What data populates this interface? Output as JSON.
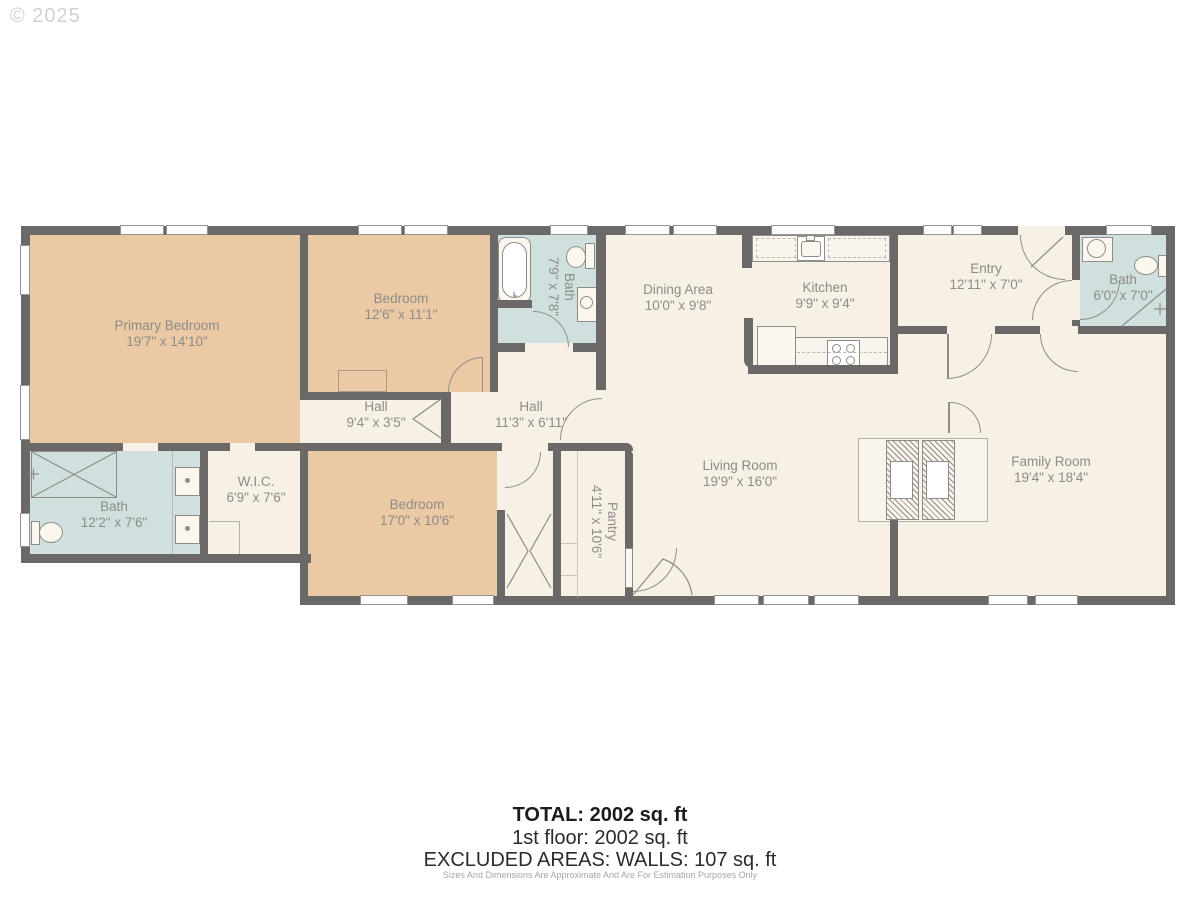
{
  "watermark": "© 2025",
  "colors": {
    "wall": "#6a6967",
    "floor": "#f7f0e4",
    "bedroom_fill": "#ebc9a4",
    "bath_fill": "#cfe0df",
    "label_text": "#8d8c89"
  },
  "rooms": {
    "primary_bedroom": {
      "name": "Primary Bedroom",
      "dims": "19'7\" x 14'10\""
    },
    "bedroom2": {
      "name": "Bedroom",
      "dims": "12'6\" x 11'1\""
    },
    "bath_hall": {
      "name": "Bath",
      "dims": "7'9\" x 7'8\""
    },
    "hall_small": {
      "name": "Hall",
      "dims": "9'4\" x 3'5\""
    },
    "hall_main": {
      "name": "Hall",
      "dims": "11'3\" x 6'11\""
    },
    "dining": {
      "name": "Dining Area",
      "dims": "10'0\" x 9'8\""
    },
    "kitchen": {
      "name": "Kitchen",
      "dims": "9'9\" x 9'4\""
    },
    "entry": {
      "name": "Entry",
      "dims": "12'11\" x 7'0\""
    },
    "bath_entry": {
      "name": "Bath",
      "dims": "6'0\" x 7'0\""
    },
    "living": {
      "name": "Living Room",
      "dims": "19'9\" x 16'0\""
    },
    "family": {
      "name": "Family Room",
      "dims": "19'4\" x 18'4\""
    },
    "bath_primary": {
      "name": "Bath",
      "dims": "12'2\" x 7'6\""
    },
    "wic": {
      "name": "W.I.C.",
      "dims": "6'9\" x 7'6\""
    },
    "bedroom3": {
      "name": "Bedroom",
      "dims": "17'0\" x 10'6\""
    },
    "pantry": {
      "name": "Pantry",
      "dims": "4'11\" x 10'6\""
    }
  },
  "summary": {
    "total": "TOTAL: 2002 sq. ft",
    "floor1": "1st floor: 2002 sq. ft",
    "excluded": "EXCLUDED AREAS: WALLS: 107 sq. ft",
    "disclaimer": "Sizes And Dimensions Are Approximate And Are For Estimation Purposes Only"
  }
}
